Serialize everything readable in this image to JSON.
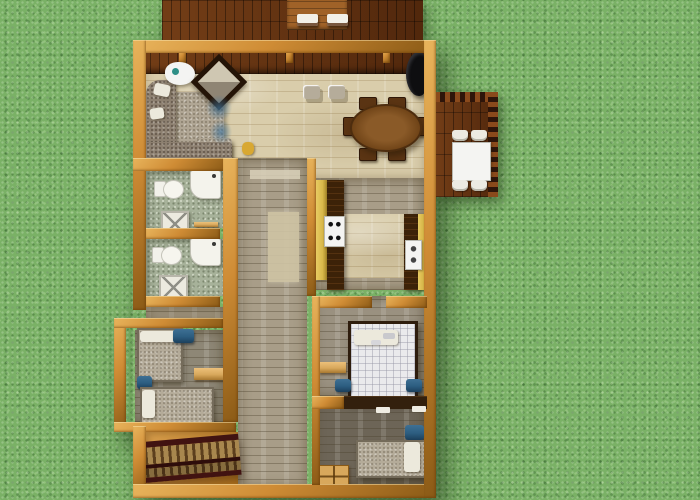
{
  "scene": {
    "description": "Top-down 3D architectural rendering of a single-story house floor plan on a grass lawn",
    "view": "top-down",
    "background": "grass-lawn"
  },
  "palette": {
    "grass": "#7ab166",
    "grass_dark": "#3f7a35",
    "grass_light": "#b8dfa0",
    "deck_wood": "#63300f",
    "deck_table": "#a06228",
    "wall": "#cf8c35",
    "wall_light": "#e8b45c",
    "wall_dark": "#8a5a16",
    "stone": "#d9cdab",
    "plank_gray": "#a89d88",
    "rug": "#cfc4a4",
    "bath_tile": "#a7b29a",
    "cabinet": "#d8b84a",
    "countertop": "#3c2208",
    "sofa_seat": "#b0a694",
    "sofa_back": "#8d8070",
    "table_wood": "#7c4c1e",
    "chair_wood": "#5a3413",
    "appliance_black": "#0e0e10",
    "fixture_white": "#f4f4f2",
    "mattress": "#b4ab99",
    "quilt": "#eaeaec",
    "pillow_blue": "#2c5d80",
    "divider_dark": "#33200d",
    "bedroom_floor": "#8e8776",
    "master_floor": "#9a9180",
    "dark_floor": "#6d6557",
    "stair_rail": "#411311",
    "stair_tread": "#a8874e",
    "shelf_tan": "#d8a85c",
    "accent_teal": "#2e8f86"
  },
  "exterior": {
    "lawn": "grass",
    "decks": [
      {
        "name": "top-deck",
        "furniture": [
          "plank-table",
          "bench-seat",
          "bench-seat"
        ]
      },
      {
        "name": "side-deck",
        "furniture": [
          "patio-table",
          "patio-chair",
          "patio-chair",
          "patio-chair",
          "patio-chair"
        ]
      }
    ]
  },
  "rooms": [
    {
      "name": "great-room",
      "floor": "light-stone-tile",
      "furniture": [
        "sectional-sofa",
        "white-throw-pillows",
        "corner-side-table",
        "accent-chair",
        "bar-stool",
        "bar-stool",
        "oval-dining-table",
        "dining-chairs-6",
        "black-wood-stove",
        "decor-item"
      ]
    },
    {
      "name": "kitchen",
      "floor": "wood-plank",
      "furniture": [
        "left-counter",
        "cooktop",
        "right-counter",
        "sink"
      ]
    },
    {
      "name": "bathroom-1",
      "floor": "green-speckled-tile",
      "furniture": [
        "toilet",
        "vanity",
        "shower-pan",
        "wall-shelf"
      ]
    },
    {
      "name": "bathroom-2",
      "floor": "green-speckled-tile",
      "furniture": [
        "toilet",
        "vanity",
        "shower-pan"
      ]
    },
    {
      "name": "hallway",
      "floor": "gray-wood-plank",
      "furniture": [
        "runner-rug"
      ]
    },
    {
      "name": "bedroom-left",
      "floor": "gray-wood-plank",
      "furniture": [
        "twin-bed",
        "twin-bed",
        "blue-nightstand",
        "blue-nightstand",
        "wall-desk"
      ]
    },
    {
      "name": "master-bedroom",
      "floor": "gray-wood-plank",
      "furniture": [
        "double-bed-white-quilt",
        "blue-pillow",
        "blue-pillow",
        "wall-shelf"
      ]
    },
    {
      "name": "bedroom-bottom",
      "floor": "dark-wood-plank",
      "furniture": [
        "single-bed",
        "blue-pillow",
        "dresser"
      ]
    },
    {
      "name": "stair-hall",
      "floor": "wood-landing",
      "furniture": [
        "staircase"
      ]
    }
  ]
}
